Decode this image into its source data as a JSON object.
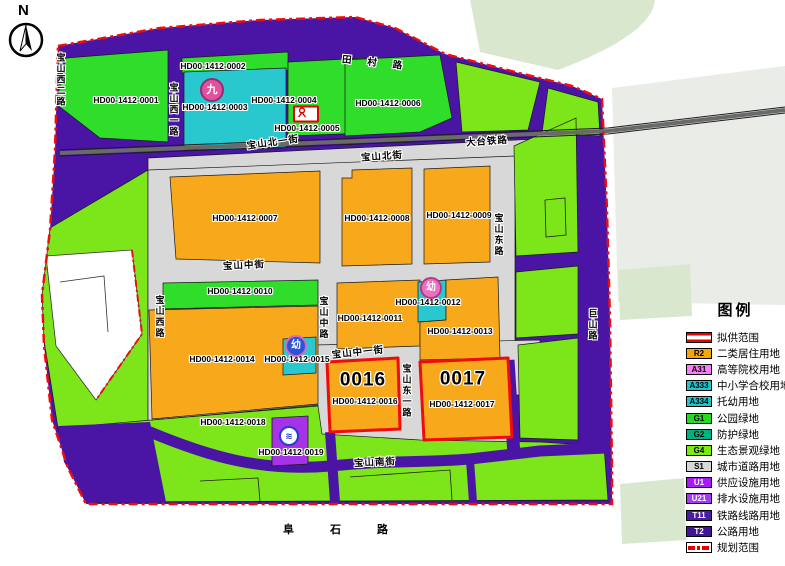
{
  "compass": {
    "north": "N"
  },
  "legend": {
    "title": "图例",
    "items": [
      {
        "code": "",
        "label": "拟供范围",
        "type": "supply-line",
        "color": "",
        "text": "#000000"
      },
      {
        "code": "R2",
        "label": "二类居住用地",
        "color": "#F5A70A",
        "text": "#000000"
      },
      {
        "code": "A31",
        "label": "高等院校用地",
        "color": "#FA7EF5",
        "text": "#000000"
      },
      {
        "code": "A333",
        "label": "中小学合校用地",
        "color": "#1EC6CE",
        "text": "#000000"
      },
      {
        "code": "A334",
        "label": "托幼用地",
        "color": "#1EC6CE",
        "text": "#000000"
      },
      {
        "code": "G1",
        "label": "公园绿地",
        "color": "#22DB22",
        "text": "#000000"
      },
      {
        "code": "G2",
        "label": "防护绿地",
        "color": "#00B17D",
        "text": "#000000"
      },
      {
        "code": "G4",
        "label": "生态景观绿地",
        "color": "#7CEB10",
        "text": "#000000"
      },
      {
        "code": "S1",
        "label": "城市道路用地",
        "color": "#D8D8D8",
        "text": "#000000"
      },
      {
        "code": "U1",
        "label": "供应设施用地",
        "color": "#A81AF8",
        "text": "#FFFFFF"
      },
      {
        "code": "U21",
        "label": "排水设施用地",
        "color": "#A43BF0",
        "text": "#FFFFFF"
      },
      {
        "code": "T11",
        "label": "铁路线路用地",
        "color": "#4B1CA8",
        "text": "#FFFFFF"
      },
      {
        "code": "T2",
        "label": "公路用地",
        "color": "#40139B",
        "text": "#FFFFFF"
      },
      {
        "code": "",
        "label": "规划范围",
        "type": "plan-line",
        "color": "",
        "text": "#000000"
      }
    ]
  },
  "map": {
    "parcels": [
      "HD00-1412-0001",
      "HD00-1412-0002",
      "HD00-1412-0003",
      "HD00-1412-0004",
      "HD00-1412-0005",
      "HD00-1412-0006",
      "HD00-1412-0007",
      "HD00-1412-0008",
      "HD00-1412-0009",
      "HD00-1412-0010",
      "HD00-1412-0011",
      "HD00-1412-0012",
      "HD00-1412-0013",
      "HD00-1412-0014",
      "HD00-1412-0015",
      "HD00-1412-0016",
      "HD00-1412-0017",
      "HD00-1412-0018",
      "HD00-1412-0019"
    ],
    "plot_numbers": {
      "p0016": "0016",
      "p0017": "0017"
    },
    "streets": {
      "tiancun_road": "田村路",
      "datai_railway": "大台铁路",
      "baoshan_north_1st_st": "宝山北一街",
      "baoshan_north_st": "宝山北街",
      "baoshan_middle_st": "宝山中街",
      "baoshan_middle_1st_st": "宝山中一街",
      "baoshan_south_st": "宝山南街",
      "baoshan_west_2nd_rd": "宝山西二路",
      "baoshan_west_1st_rd": "宝山西一路",
      "baoshan_west_rd": "宝山西路",
      "baoshan_middle_rd": "宝山中路",
      "baoshan_east_rd": "宝山东路",
      "baoshan_east_1st_rd": "宝山东一路",
      "jushan_rd": "巨山路",
      "fushi_rd": "阜石路"
    },
    "icons": {
      "school_badge": "九",
      "kindergarten_badge_1": "幼",
      "kindergarten_badge_2": "幼",
      "drainage_badge": "≋"
    }
  }
}
